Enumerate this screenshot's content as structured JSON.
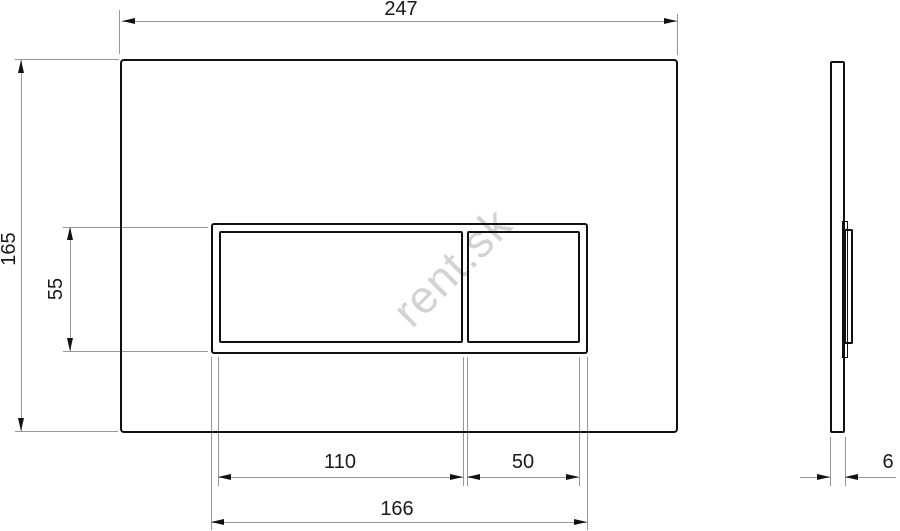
{
  "watermark": {
    "text": "rent.sk",
    "rotation_deg": -45
  },
  "dims": {
    "plate_width": "247",
    "plate_height": "165",
    "button_cutout_height": "55",
    "large_button_width": "110",
    "small_button_width": "50",
    "button_frame_width": "166",
    "plate_thickness": "6"
  },
  "colors": {
    "outline": "#111111",
    "dimension_line": "#979797",
    "text": "#1a1a1a",
    "watermark": "#d3d3d3",
    "background": "#ffffff"
  }
}
